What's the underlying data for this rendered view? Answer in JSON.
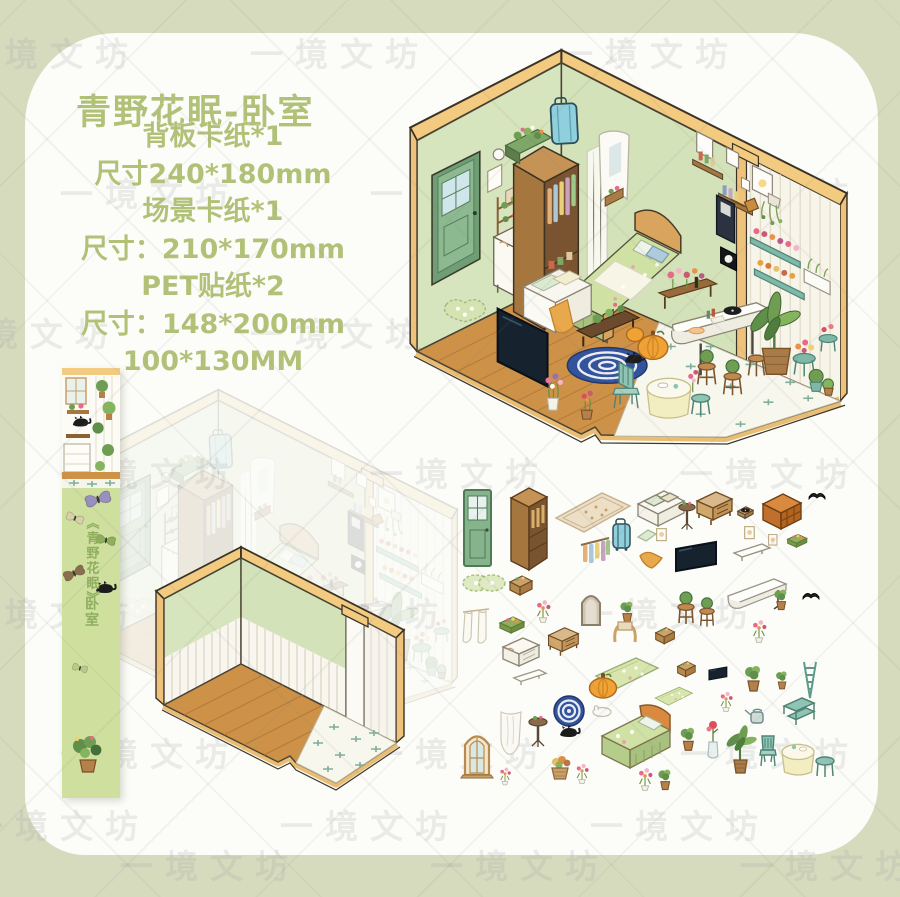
{
  "page": {
    "watermark": "一境文坊",
    "background_color": "#d7dbbe",
    "panel_color": "#fcfdf9"
  },
  "header": {
    "title": "青野花眠-卧室",
    "title_color": "#b2c178"
  },
  "specs": {
    "lines": [
      "背板卡纸*1",
      "尺寸240*180mm",
      "场景卡纸*1",
      "尺寸：210*170mm",
      "PET贴纸*2",
      "尺寸：148*200mm",
      "100*130MM"
    ]
  },
  "bookmark": {
    "series_title": "《青野花眠》",
    "room_label": "卧室"
  },
  "colors": {
    "wall_green": "#d7e5be",
    "frame_tan": "#f2ca80",
    "floor_wood": "#cd9148",
    "tile_white": "#f8f7ee",
    "tv_dark": "#16222e",
    "suitcase_teal": "#8fd0dc",
    "bed_green": "#cfe2a4",
    "pumpkin_orange": "#f0a235",
    "rug_navy": "#33549c",
    "bookmark_green": "#cfdf9e"
  },
  "stickers": {
    "items": [
      {
        "t": "door",
        "x": 12,
        "y": 14
      },
      {
        "t": "wardrobe",
        "x": 50,
        "y": 12
      },
      {
        "t": "rugflat",
        "x": 104,
        "y": 16
      },
      {
        "t": "daybed",
        "x": 182,
        "y": 12
      },
      {
        "t": "pedestal",
        "x": 226,
        "y": 26,
        "s": 0.9
      },
      {
        "t": "sideboard",
        "x": 242,
        "y": 16
      },
      {
        "t": "record",
        "x": 284,
        "y": 30,
        "s": 0.9
      },
      {
        "t": "cabinetorange",
        "x": 306,
        "y": 18
      },
      {
        "t": "book",
        "x": 356,
        "y": 14
      },
      {
        "t": "crate",
        "x": 334,
        "y": 58,
        "s": 0.8
      },
      {
        "t": "picture",
        "x": 292,
        "y": 52,
        "s": 0.8
      },
      {
        "t": "lacerug",
        "x": 10,
        "y": 98
      },
      {
        "t": "shelftan",
        "x": 56,
        "y": 100
      },
      {
        "t": "clothesrack",
        "x": 128,
        "y": 62
      },
      {
        "t": "suitcase",
        "x": 160,
        "y": 44
      },
      {
        "t": "pillow",
        "x": 184,
        "y": 54
      },
      {
        "t": "picture",
        "x": 204,
        "y": 54,
        "s": 0.8
      },
      {
        "t": "towel",
        "x": 186,
        "y": 76
      },
      {
        "t": "tv",
        "x": 222,
        "y": 66
      },
      {
        "t": "shelfL",
        "x": 280,
        "y": 68
      },
      {
        "t": "picture",
        "x": 316,
        "y": 60,
        "s": 0.7
      },
      {
        "t": "curtain",
        "x": 10,
        "y": 134
      },
      {
        "t": "crate",
        "x": 46,
        "y": 140
      },
      {
        "t": "flower",
        "x": 82,
        "y": 124,
        "s": 0.9
      },
      {
        "t": "archmirror",
        "x": 128,
        "y": 116
      },
      {
        "t": "plant",
        "x": 166,
        "y": 126,
        "s": 0.8
      },
      {
        "t": "sideboard",
        "x": 94,
        "y": 152,
        "s": 0.85
      },
      {
        "t": "horserack",
        "x": 158,
        "y": 144
      },
      {
        "t": "shelftan",
        "x": 202,
        "y": 152,
        "s": 0.85
      },
      {
        "t": "stoolplant",
        "x": 224,
        "y": 116
      },
      {
        "t": "stoolplant",
        "x": 246,
        "y": 122,
        "s": 0.9
      },
      {
        "t": "counter",
        "x": 274,
        "y": 100
      },
      {
        "t": "plant",
        "x": 320,
        "y": 114,
        "s": 0.8
      },
      {
        "t": "book",
        "x": 350,
        "y": 114
      },
      {
        "t": "flower",
        "x": 298,
        "y": 144,
        "s": 0.9
      },
      {
        "t": "dresserw",
        "x": 48,
        "y": 162
      },
      {
        "t": "shelfL",
        "x": 60,
        "y": 194,
        "s": 0.9
      },
      {
        "t": "sheercurtain",
        "x": 46,
        "y": 236
      },
      {
        "t": "quilt",
        "x": 142,
        "y": 182
      },
      {
        "t": "pumpkin",
        "x": 136,
        "y": 198
      },
      {
        "t": "ruground",
        "x": 100,
        "y": 220
      },
      {
        "t": "bunny",
        "x": 138,
        "y": 230
      },
      {
        "t": "cat",
        "x": 104,
        "y": 250
      },
      {
        "t": "pedestal",
        "x": 76,
        "y": 240
      },
      {
        "t": "windowarch",
        "x": 10,
        "y": 256
      },
      {
        "t": "flower",
        "x": 46,
        "y": 292,
        "s": 0.7
      },
      {
        "t": "plantbasket",
        "x": 94,
        "y": 280
      },
      {
        "t": "flower",
        "x": 122,
        "y": 288,
        "s": 0.8
      },
      {
        "t": "bed",
        "x": 136,
        "y": 228
      },
      {
        "t": "quilt",
        "x": 202,
        "y": 212,
        "s": 0.6
      },
      {
        "t": "shelftan",
        "x": 224,
        "y": 186,
        "s": 0.8
      },
      {
        "t": "tv",
        "x": 256,
        "y": 192,
        "s": 0.45
      },
      {
        "t": "plant",
        "x": 290,
        "y": 190
      },
      {
        "t": "plant",
        "x": 322,
        "y": 196,
        "s": 0.7
      },
      {
        "t": "flower",
        "x": 266,
        "y": 216,
        "s": 0.8
      },
      {
        "t": "ladder",
        "x": 348,
        "y": 186
      },
      {
        "t": "shelf2tier",
        "x": 330,
        "y": 220
      },
      {
        "t": "watercan",
        "x": 292,
        "y": 232
      },
      {
        "t": "plant",
        "x": 226,
        "y": 252,
        "s": 0.9
      },
      {
        "t": "vaserose",
        "x": 252,
        "y": 246
      },
      {
        "t": "planttall",
        "x": 274,
        "y": 254
      },
      {
        "t": "chairteal",
        "x": 306,
        "y": 260
      },
      {
        "t": "tableset",
        "x": 324,
        "y": 262
      },
      {
        "t": "flower",
        "x": 184,
        "y": 292,
        "s": 0.9
      },
      {
        "t": "plant",
        "x": 204,
        "y": 294,
        "s": 0.8
      }
    ]
  }
}
